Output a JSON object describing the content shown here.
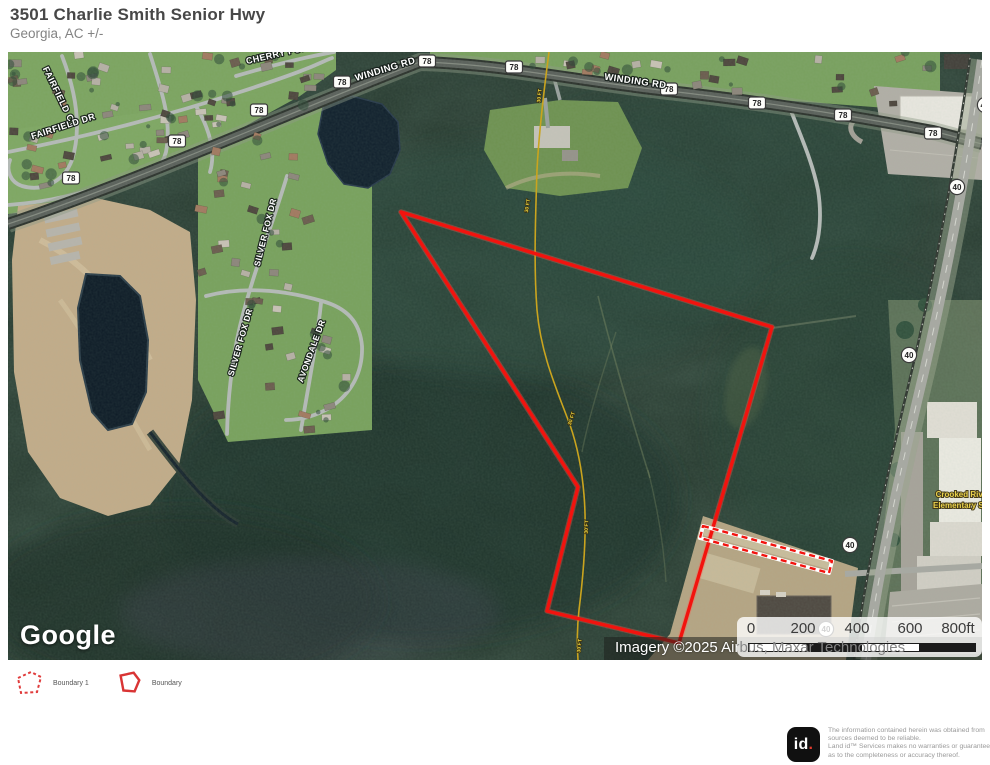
{
  "header": {
    "title": "3501 Charlie Smith Senior Hwy",
    "subtitle": "Georgia,  AC +/-"
  },
  "map": {
    "google_logo": "Google",
    "attribution": "Imagery ©2025 Airbus, Maxar Technologies",
    "scale_ticks": [
      "0",
      "200",
      "400",
      "600",
      "800ft"
    ],
    "road_labels": [
      {
        "text": "FAIRFIELD CT",
        "x": 57,
        "y": 98,
        "rot": 64,
        "size": 9
      },
      {
        "text": "FAIRFIELD DR",
        "x": 64,
        "y": 129,
        "rot": -18,
        "size": 9
      },
      {
        "text": "CHERRY POINT",
        "x": 282,
        "y": 56,
        "rot": -13,
        "size": 9
      },
      {
        "text": "WINDING RD",
        "x": 386,
        "y": 72,
        "rot": -17,
        "size": 9.5
      },
      {
        "text": "WINDING RD",
        "x": 635,
        "y": 84,
        "rot": 8,
        "size": 9.5
      },
      {
        "text": "SILVER FOX DR",
        "x": 268,
        "y": 233,
        "rot": -76,
        "size": 8.5
      },
      {
        "text": "SILVER FOX DR",
        "x": 243,
        "y": 343,
        "rot": -74,
        "size": 8.5
      },
      {
        "text": "AVONDALE DR",
        "x": 314,
        "y": 352,
        "rot": -70,
        "size": 8.5
      }
    ],
    "route_shields_78": [
      {
        "x": 71,
        "y": 178
      },
      {
        "x": 177,
        "y": 141
      },
      {
        "x": 259,
        "y": 110
      },
      {
        "x": 342,
        "y": 82
      },
      {
        "x": 427,
        "y": 61
      },
      {
        "x": 514,
        "y": 67
      },
      {
        "x": 669,
        "y": 89
      },
      {
        "x": 757,
        "y": 103
      },
      {
        "x": 843,
        "y": 115
      },
      {
        "x": 933,
        "y": 133
      }
    ],
    "route_shields_40": [
      {
        "x": 985,
        "y": 105
      },
      {
        "x": 957,
        "y": 187
      },
      {
        "x": 909,
        "y": 355
      },
      {
        "x": 850,
        "y": 545
      },
      {
        "x": 826,
        "y": 629
      }
    ],
    "pipeline_label": "30 FT",
    "pipeline_label_positions": [
      {
        "x": 541,
        "y": 96,
        "rot": -84
      },
      {
        "x": 529,
        "y": 206,
        "rot": -80
      },
      {
        "x": 573,
        "y": 419,
        "rot": -72
      },
      {
        "x": 588,
        "y": 527,
        "rot": -88
      },
      {
        "x": 581,
        "y": 646,
        "rot": -84
      }
    ],
    "poi_school": {
      "lines": [
        "Crooked River",
        "Elementary Sch"
      ],
      "x": 963,
      "y": 497
    },
    "boundaries": {
      "main": {
        "name": "Boundary",
        "style": "solid",
        "color": "#f2130e",
        "points": "401,212 772,327 679,643 547,611 578,487"
      },
      "strip": {
        "name": "Boundary 1",
        "style": "dashed",
        "color": "#f2130e",
        "points": "703,526 832,561 829,573 700,538"
      }
    }
  },
  "legend": {
    "items": [
      {
        "label": "Boundary 1",
        "style": "dashed"
      },
      {
        "label": "Boundary",
        "style": "solid"
      }
    ]
  },
  "footer": {
    "logo_text": "id",
    "logo_dot": ".",
    "disclaimer_lines": [
      "The information contained herein was obtained from",
      "sources deemed to be reliable.",
      " Land id™ Services makes no warranties or guarantees",
      "as to the completeness or accuracy thereof."
    ]
  },
  "colors": {
    "boundary_red": "#f2130e",
    "pipeline_yellow": "#d8b31c",
    "shield_fill": "#fdfdfa",
    "poi_yellow": "#e8d04b"
  }
}
